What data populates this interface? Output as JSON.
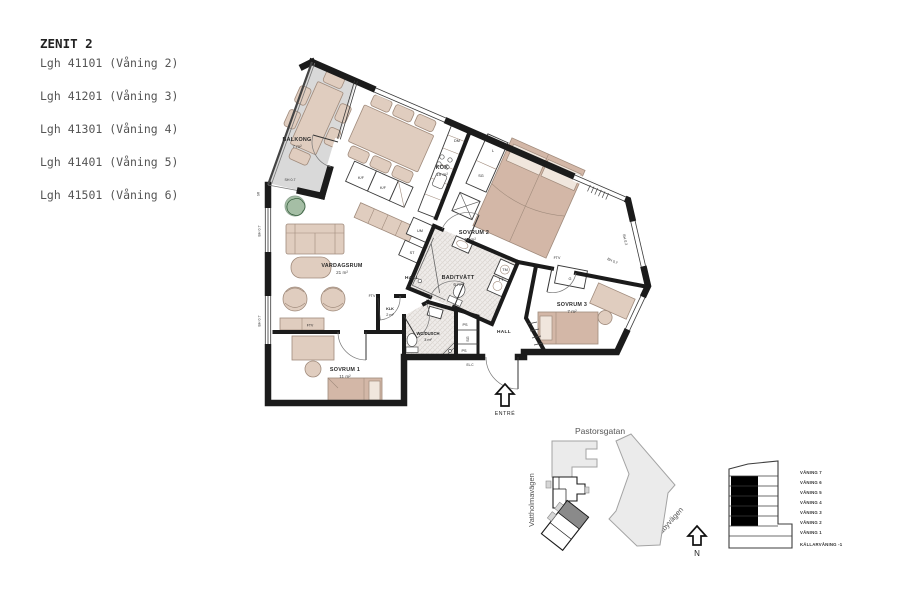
{
  "header": {
    "title": "ZENIT 2",
    "apartments": [
      "Lgh 41101 (Våning 2)",
      "Lgh 41201 (Våning 3)",
      "Lgh 41301 (Våning 4)",
      "Lgh 41401 (Våning 5)",
      "Lgh 41501 (Våning 6)"
    ]
  },
  "plan": {
    "rooms": {
      "balkong": {
        "name": "BALKONG",
        "area": "7 m²"
      },
      "kok": {
        "name": "KÖK",
        "area": "19 m²"
      },
      "sovrum2": {
        "name": "SOVRUM 2",
        "area": "13 m²"
      },
      "sovrum3": {
        "name": "SOVRUM 3",
        "area": "7 m²"
      },
      "sovrum1": {
        "name": "SOVRUM 1",
        "area": "11 m²"
      },
      "vardagsrum": {
        "name": "VARDAGSRUM",
        "area": "21 m²"
      },
      "badtvatt": {
        "name": "BAD/TVÄTT",
        "area": "6 m²"
      },
      "wcdusch": {
        "name": "WC/DUSCH",
        "area": "3 m²"
      },
      "klk": {
        "name": "KLK",
        "area": "2 m²"
      },
      "hall_upper": "HALL",
      "hall_lower": "HALL"
    },
    "fixtures": {
      "dm": "DM",
      "kf1": "K/F",
      "kf2": "K/F",
      "um": "UM",
      "st": "ST",
      "l": "L",
      "sg_wardrobe": "SG",
      "tm": "TM",
      "tt": "TT",
      "g": "G",
      "ps_upper": "PS",
      "ps_lower": "PS",
      "sg_closet": "SG",
      "elc": "EL.C",
      "ftv_sovrum2": "FTV",
      "ftv_vardagsrum": "FTV",
      "ftv_sovrum1": "FTV",
      "sr": "SR"
    },
    "window_labels": {
      "balcony_screen": "SH 0.7",
      "left_upper": "BH 0.7",
      "left_lower": "BH 0.7",
      "east": "BH 0.2",
      "sovrum3": "BH 0.7"
    },
    "entrance": "ENTRÉ"
  },
  "site_plan": {
    "street_north": "Pastorsgatan",
    "street_west": "Vattholmavägen",
    "street_east": "Råbyvägen",
    "north_label": "N"
  },
  "section": {
    "floors": [
      "VÅNING 7",
      "VÅNING 6",
      "VÅNING 5",
      "VÅNING 4",
      "VÅNING 3",
      "VÅNING 2",
      "VÅNING 1",
      "KÄLLARVÅNING -1"
    ]
  },
  "colors": {
    "wall": "#1b1b1b",
    "furniture_fill": "#e0cdbf",
    "furniture_stroke": "#a08b7c",
    "bed_fill": "#d3b7a7",
    "balcony_floor": "#d9d9d9",
    "site_building": "#ebebeb",
    "highlight_unit": "#8a8a8a",
    "plant": "#5d8a5d"
  }
}
